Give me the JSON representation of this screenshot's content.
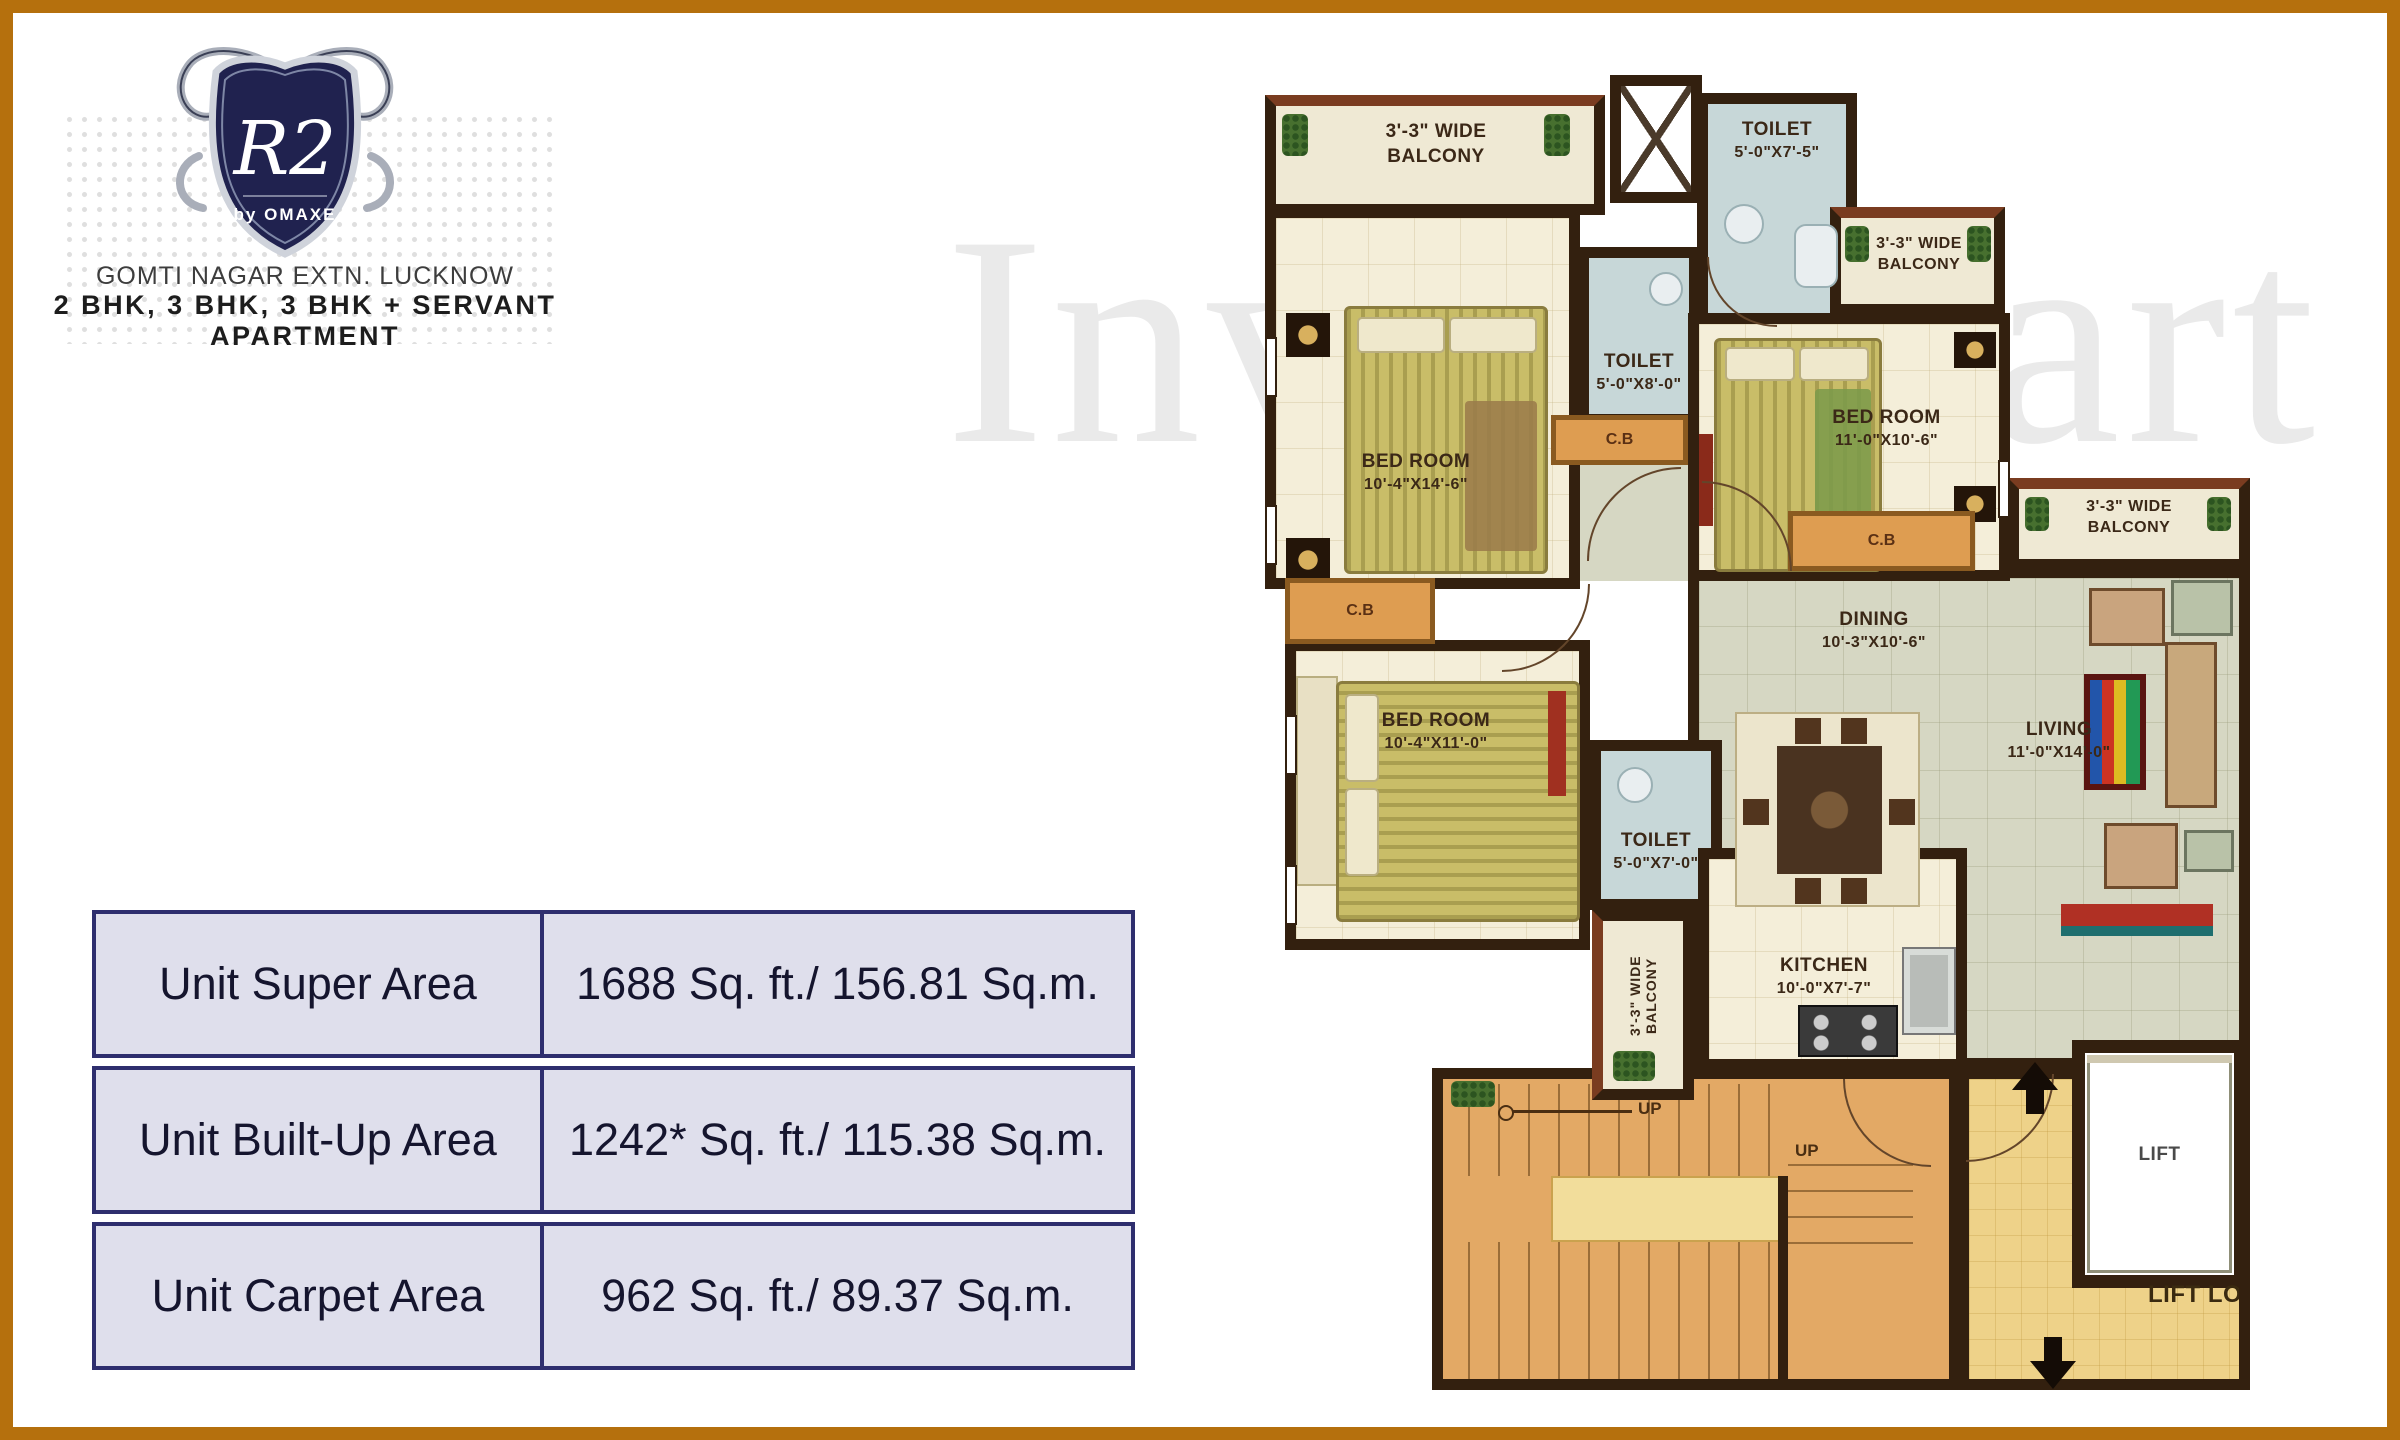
{
  "logo": {
    "brand": "R2",
    "brand_sub": "by OMAXE",
    "location": "GOMTI NAGAR EXTN. LUCKNOW",
    "tagline": "2 BHK, 3 BHK, 3 BHK + SERVANT APARTMENT"
  },
  "watermark": {
    "text": "InvestMart"
  },
  "area_table": {
    "rows": [
      {
        "label": "Unit Super Area",
        "value": "1688 Sq. ft./ 156.81 Sq.m."
      },
      {
        "label": "Unit Built-Up Area",
        "value": "1242* Sq. ft./ 115.38 Sq.m."
      },
      {
        "label": "Unit Carpet Area",
        "value": "962 Sq. ft./ 89.37 Sq.m."
      }
    ]
  },
  "floor_plan": {
    "balcony_top_left": {
      "line1": "3'-3\" WIDE",
      "line2": "BALCONY"
    },
    "toilet_top": {
      "line1": "TOILET",
      "line2": "5'-0\"X7'-5\""
    },
    "toilet_mid": {
      "line1": "TOILET",
      "line2": "5'-0\"X8'-0\""
    },
    "bedroom_1": {
      "line1": "BED ROOM",
      "line2": "10'-4\"X14'-6\""
    },
    "balcony_top_right": {
      "line1": "3'-3\" WIDE",
      "line2": "BALCONY"
    },
    "bedroom_2": {
      "line1": "BED ROOM",
      "line2": "11'-0\"X10'-6\""
    },
    "balcony_right": {
      "line1": "3'-3\" WIDE",
      "line2": "BALCONY"
    },
    "cb_label": "C.B",
    "dining": {
      "line1": "DINING",
      "line2": "10'-3\"X10'-6\""
    },
    "living": {
      "line1": "LIVING",
      "line2": "11'-0\"X14'-0\""
    },
    "bedroom_3": {
      "line1": "BED ROOM",
      "line2": "10'-4\"X11'-0\""
    },
    "toilet_bottom": {
      "line1": "TOILET",
      "line2": "5'-0\"X7'-0\""
    },
    "balcony_side": {
      "label": "3'-3\" WIDE BALCONY"
    },
    "kitchen": {
      "line1": "KITCHEN",
      "line2": "10'-0\"X7'-7\""
    },
    "stairs": {
      "up1": "UP",
      "up2": "UP"
    },
    "lift": {
      "label": "LIFT"
    },
    "lift_lobby": {
      "label": "LIFT LOBBY"
    }
  },
  "colors": {
    "frame_border": "#b5700d",
    "wall": "#33200f",
    "table_border": "#2e2e6e",
    "table_bg": "#dfdfec",
    "shield_navy": "#20224f",
    "toilet_floor": "#c7d7d8",
    "living_floor": "#d6d7c3",
    "stairs_floor": "#e3a965",
    "lobby_floor": "#eed289",
    "cupboard": "#de9d51"
  }
}
